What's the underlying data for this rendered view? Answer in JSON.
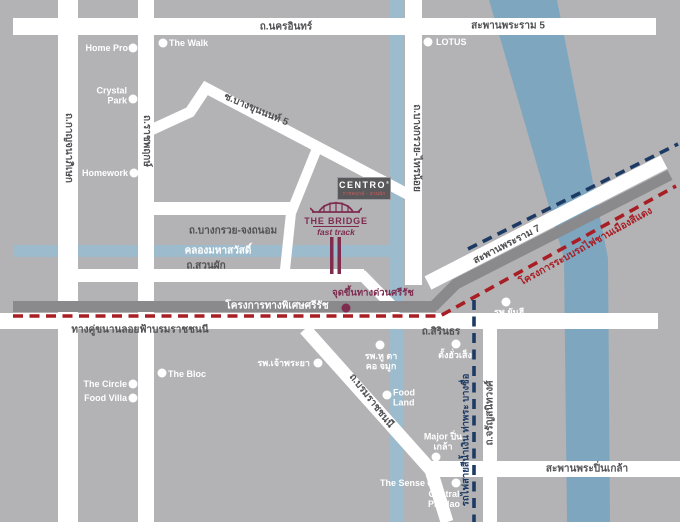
{
  "roads": {
    "nakhon_in": "ถ.นครอินทร์",
    "rama5": "สะพานพระราม 5",
    "kanchanaphisek": "ถ.กาญจนาภิเษก",
    "ratchaphruek": "ถ.ราชพฤกษ์",
    "bangkruai_sainoi": "ถ.บางกรวย-ไทรน้อย",
    "bang_khun_non_5": "ซ.บางขุนนนท์ 5",
    "bangkruai_chongthanom": "ถ.บางกรวย-จงถนอม",
    "suan_phak": "ถ.สวนผัก",
    "borom_parallel": "ทางคู่ขนานลอยฟ้าบรมราชชนนี",
    "sirindhorn": "ถ.สิรินธร",
    "rama7": "สะพานพระราม 7",
    "borom": "ถ.บรมราชชนนี",
    "charan": "ถ.จรัญสนิทวงศ์",
    "pinklao": "สะพานพระปิ่นเกล้า"
  },
  "water": {
    "mahasawat": "คลองมหาสวัสดิ์"
  },
  "expressway": {
    "sirat": "โครงการทางพิเศษศรีรัช",
    "entrance": "จุดขึ้นทางด่วนศรีรัช"
  },
  "transit": {
    "red_line": "โครงการระบบรถไฟชานเมืองสีแดง",
    "blue_line": "รถไฟสายสีน้ำเงิน ท่าพระ บางซื่อ"
  },
  "landmarks": {
    "home_pro": "Home Pro",
    "the_walk": "The Walk",
    "crystal_park": "Crystal Park",
    "homework": "Homework",
    "lotus": "LOTUS",
    "the_bloc": "The Bloc",
    "the_circle": "The Circle",
    "food_villa": "Food Villa",
    "chaophraya_hospital": "รพ.เจ้าพระยา",
    "ent_hospital": "รพ.หู ตา คอ จมูก",
    "tang_hua_seng": "ตั้งฮั่วเส็ง",
    "food_land": "Food Land",
    "major_pinklao": "Major ปิ่นเกล้า",
    "the_sense": "The Sense",
    "central_pinklao": "Central Pinklao",
    "yanhee_hospital": "รพ.ยันฮี"
  },
  "project": {
    "name": "CENTRO",
    "registered": "®",
    "tagline": "ราชพฤกษ์ - สวนผัก",
    "bridge": "THE BRIDGE",
    "bridge_sub": "fast track"
  },
  "colors": {
    "background": "#b3b2b4",
    "road": "#ffffff",
    "river": "#7fa6bf",
    "canal": "#9cbbcc",
    "expressway": "#8a8a8c",
    "red_line": "#a81e24",
    "blue_line": "#1d3a64",
    "maroon": "#7e2c50",
    "label": "#515154",
    "centro_box": "#58585a",
    "tagline": "#b05a5a"
  }
}
